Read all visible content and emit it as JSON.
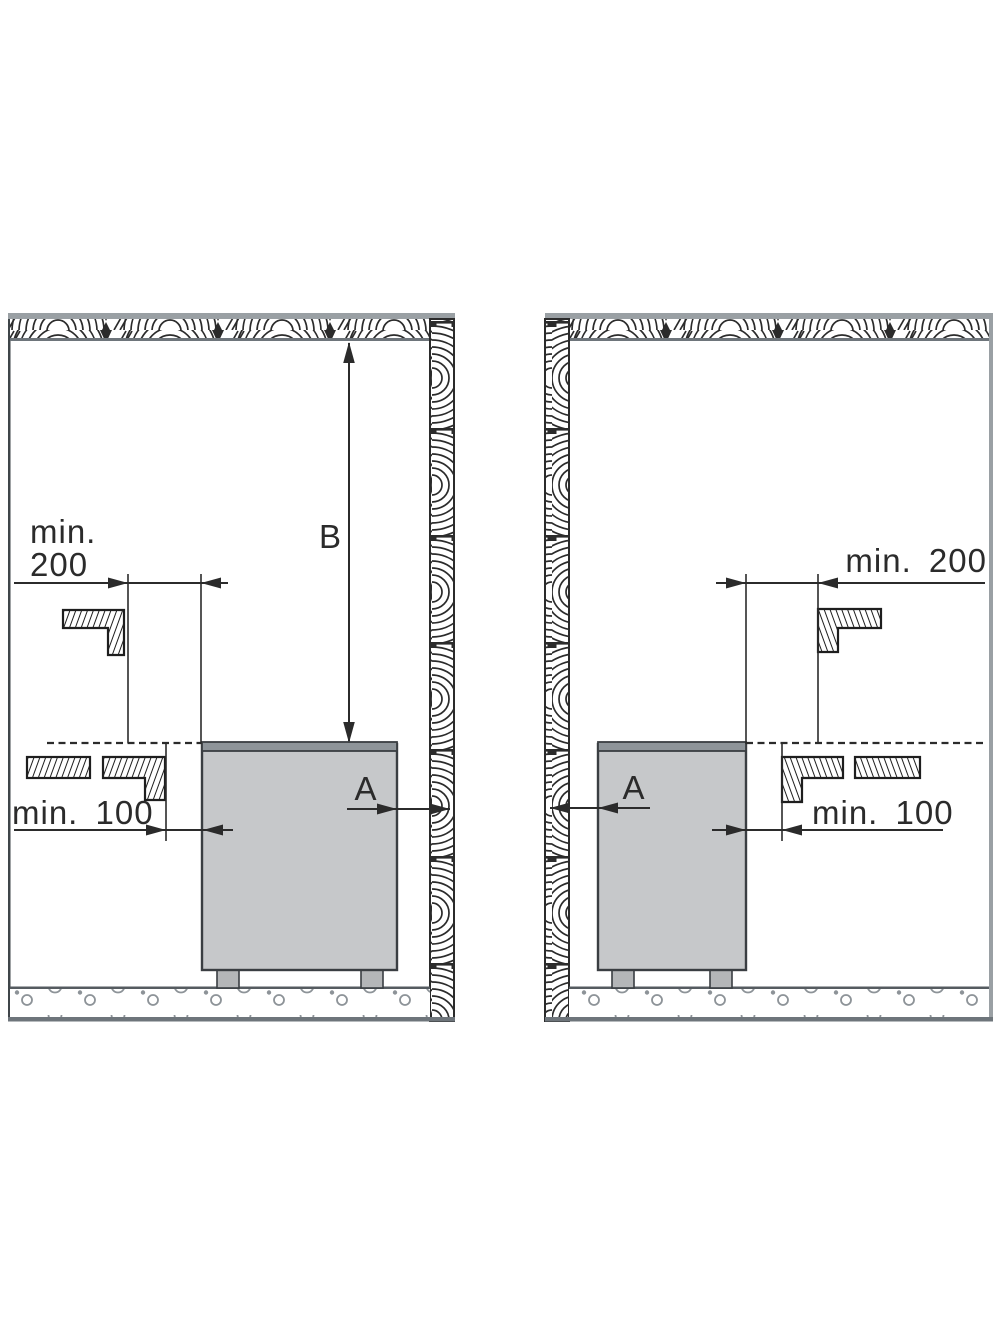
{
  "figure": {
    "description": "Sauna heater installation minimum safety distances, two wall/corner placement examples",
    "panels": [
      {
        "id": "left-panel",
        "labels": {
          "min200_line1": "min.",
          "min200_line2": "200",
          "min100": "min. 100",
          "height_dim": "B",
          "side_dim": "A"
        }
      },
      {
        "id": "right-panel",
        "labels": {
          "min200": "min. 200",
          "min100": "min. 100",
          "side_dim": "A"
        }
      }
    ]
  },
  "colors": {
    "heater_body": "#c6c8ca",
    "heater_top": "#8e9499",
    "heater_feet": "#b4b6b8",
    "line": "#2b2b2b",
    "wall_gray": "#9aa0a4",
    "floor_band": "#6e757b"
  }
}
